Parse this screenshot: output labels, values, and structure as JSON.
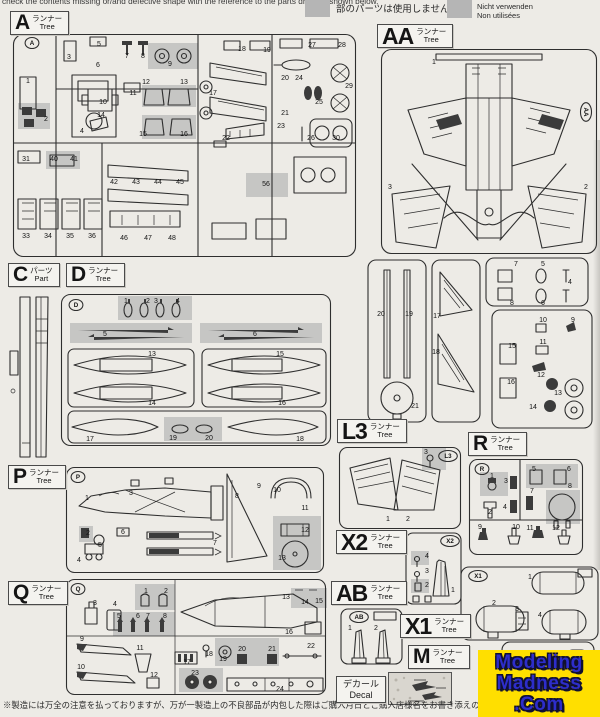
{
  "header": {
    "notice_en": "check the contents missing or/and defective shape with the reference to the parts drawing shown below.",
    "gray_note_jp": "部のパーツは使用しません。",
    "gray_note_en": "Parts not for use.",
    "gray_note_de": "Nicht verwenden",
    "gray_note_fr": "Non utilisées",
    "swatch_color": "#b5b5b5"
  },
  "tree_labels": {
    "A": {
      "letter": "A",
      "jp": "ランナー",
      "en": "Tree"
    },
    "AA": {
      "letter": "AA",
      "jp": "ランナー",
      "en": "Tree"
    },
    "C": {
      "letter": "C",
      "jp": "パーツ",
      "en": "Part"
    },
    "D": {
      "letter": "D",
      "jp": "ランナー",
      "en": "Tree"
    },
    "L3": {
      "letter": "L3",
      "jp": "ランナー",
      "en": "Tree"
    },
    "R": {
      "letter": "R",
      "jp": "ランナー",
      "en": "Tree"
    },
    "P": {
      "letter": "P",
      "jp": "ランナー",
      "en": "Tree"
    },
    "X2": {
      "letter": "X2",
      "jp": "ランナー",
      "en": "Tree"
    },
    "Q": {
      "letter": "Q",
      "jp": "ランナー",
      "en": "Tree"
    },
    "AB": {
      "letter": "AB",
      "jp": "ランナー",
      "en": "Tree"
    },
    "X1": {
      "letter": "X1",
      "jp": "ランナー",
      "en": "Tree"
    },
    "M": {
      "letter": "M",
      "jp": "ランナー",
      "en": "Tree"
    },
    "decal": {
      "jp": "デカール",
      "en": "Decal"
    }
  },
  "sprues": {
    "A": {
      "markers": [
        {
          "t": "A",
          "x": 20,
          "y": 10
        }
      ],
      "parts": [
        {
          "n": "1",
          "x": 16,
          "y": 50
        },
        {
          "n": "2",
          "x": 34,
          "y": 88
        },
        {
          "n": "3",
          "x": 57,
          "y": 26
        },
        {
          "n": "4",
          "x": 70,
          "y": 100
        },
        {
          "n": "5",
          "x": 87,
          "y": 13
        },
        {
          "n": "6",
          "x": 86,
          "y": 34
        },
        {
          "n": "7",
          "x": 115,
          "y": 25
        },
        {
          "n": "8",
          "x": 131,
          "y": 25
        },
        {
          "n": "9",
          "x": 158,
          "y": 33
        },
        {
          "n": "10",
          "x": 91,
          "y": 71
        },
        {
          "n": "11",
          "x": 121,
          "y": 62
        },
        {
          "n": "12",
          "x": 134,
          "y": 51
        },
        {
          "n": "13",
          "x": 172,
          "y": 51
        },
        {
          "n": "14",
          "x": 89,
          "y": 84
        },
        {
          "n": "15",
          "x": 131,
          "y": 103
        },
        {
          "n": "16",
          "x": 172,
          "y": 103
        },
        {
          "n": "17",
          "x": 201,
          "y": 62
        },
        {
          "n": "18",
          "x": 230,
          "y": 18
        },
        {
          "n": "19",
          "x": 255,
          "y": 19
        },
        {
          "n": "20",
          "x": 273,
          "y": 47
        },
        {
          "n": "21",
          "x": 273,
          "y": 82
        },
        {
          "n": "22",
          "x": 214,
          "y": 107
        },
        {
          "n": "23",
          "x": 269,
          "y": 95
        },
        {
          "n": "24",
          "x": 287,
          "y": 47
        },
        {
          "n": "25",
          "x": 307,
          "y": 71
        },
        {
          "n": "26",
          "x": 299,
          "y": 107
        },
        {
          "n": "27",
          "x": 300,
          "y": 14
        },
        {
          "n": "28",
          "x": 330,
          "y": 14
        },
        {
          "n": "29",
          "x": 337,
          "y": 55
        },
        {
          "n": "30",
          "x": 324,
          "y": 107
        },
        {
          "n": "31",
          "x": 14,
          "y": 128
        },
        {
          "n": "40",
          "x": 42,
          "y": 128
        },
        {
          "n": "41",
          "x": 62,
          "y": 128
        },
        {
          "n": "33",
          "x": 14,
          "y": 205
        },
        {
          "n": "34",
          "x": 36,
          "y": 205
        },
        {
          "n": "35",
          "x": 58,
          "y": 205
        },
        {
          "n": "36",
          "x": 80,
          "y": 205
        },
        {
          "n": "42",
          "x": 102,
          "y": 151
        },
        {
          "n": "43",
          "x": 124,
          "y": 151
        },
        {
          "n": "44",
          "x": 146,
          "y": 151
        },
        {
          "n": "45",
          "x": 168,
          "y": 151
        },
        {
          "n": "46",
          "x": 112,
          "y": 207
        },
        {
          "n": "47",
          "x": 136,
          "y": 207
        },
        {
          "n": "48",
          "x": 160,
          "y": 207
        },
        {
          "n": "56",
          "x": 254,
          "y": 153
        }
      ]
    },
    "AA_main": {
      "markers": [
        {
          "t": "AA",
          "x": 206,
          "y": 64,
          "rot": 90
        }
      ],
      "parts": [
        {
          "n": "1",
          "x": 54,
          "y": 16
        },
        {
          "n": "3",
          "x": 10,
          "y": 141
        },
        {
          "n": "2",
          "x": 206,
          "y": 141
        }
      ]
    },
    "AA_lower": {
      "markers": [],
      "parts": [
        {
          "n": "20",
          "x": 21,
          "y": 58
        },
        {
          "n": "19",
          "x": 49,
          "y": 58
        },
        {
          "n": "21",
          "x": 55,
          "y": 150
        },
        {
          "n": "17",
          "x": 77,
          "y": 60
        },
        {
          "n": "18",
          "x": 76,
          "y": 96
        },
        {
          "n": "7",
          "x": 156,
          "y": 8
        },
        {
          "n": "5",
          "x": 183,
          "y": 8
        },
        {
          "n": "8",
          "x": 152,
          "y": 47
        },
        {
          "n": "6",
          "x": 183,
          "y": 47
        },
        {
          "n": "4",
          "x": 210,
          "y": 26
        },
        {
          "n": "10",
          "x": 183,
          "y": 64
        },
        {
          "n": "9",
          "x": 213,
          "y": 64
        },
        {
          "n": "11",
          "x": 183,
          "y": 86
        },
        {
          "n": "15",
          "x": 152,
          "y": 90
        },
        {
          "n": "12",
          "x": 181,
          "y": 119
        },
        {
          "n": "16",
          "x": 151,
          "y": 126
        },
        {
          "n": "13",
          "x": 198,
          "y": 137
        },
        {
          "n": "14",
          "x": 173,
          "y": 151
        }
      ]
    },
    "D": {
      "markers": [
        {
          "t": "D",
          "x": 16,
          "y": 12
        }
      ],
      "parts": [
        {
          "n": "1",
          "x": 66,
          "y": 10
        },
        {
          "n": "2",
          "x": 88,
          "y": 10
        },
        {
          "n": "3",
          "x": 96,
          "y": 10
        },
        {
          "n": "4",
          "x": 118,
          "y": 10
        },
        {
          "n": "5",
          "x": 45,
          "y": 43
        },
        {
          "n": "6",
          "x": 195,
          "y": 43
        },
        {
          "n": "13",
          "x": 92,
          "y": 63
        },
        {
          "n": "14",
          "x": 92,
          "y": 112
        },
        {
          "n": "15",
          "x": 220,
          "y": 63
        },
        {
          "n": "16",
          "x": 222,
          "y": 112
        },
        {
          "n": "17",
          "x": 30,
          "y": 148
        },
        {
          "n": "18",
          "x": 240,
          "y": 148
        },
        {
          "n": "19",
          "x": 113,
          "y": 147
        },
        {
          "n": "20",
          "x": 149,
          "y": 147
        }
      ]
    },
    "L3": {
      "markers": [
        {
          "t": "L3",
          "x": 110,
          "y": 10
        }
      ],
      "parts": [
        {
          "n": "1",
          "x": 50,
          "y": 75
        },
        {
          "n": "2",
          "x": 70,
          "y": 75
        },
        {
          "n": "3",
          "x": 88,
          "y": 8
        }
      ]
    },
    "R": {
      "markers": [
        {
          "t": "R",
          "x": 14,
          "y": 11
        }
      ],
      "parts": [
        {
          "n": "1",
          "x": 24,
          "y": 20
        },
        {
          "n": "2",
          "x": 22,
          "y": 56
        },
        {
          "n": "3",
          "x": 38,
          "y": 25
        },
        {
          "n": "4",
          "x": 37,
          "y": 51
        },
        {
          "n": "5",
          "x": 66,
          "y": 13
        },
        {
          "n": "6",
          "x": 101,
          "y": 13
        },
        {
          "n": "7",
          "x": 64,
          "y": 35
        },
        {
          "n": "8",
          "x": 102,
          "y": 30
        },
        {
          "n": "9",
          "x": 12,
          "y": 71
        },
        {
          "n": "10",
          "x": 48,
          "y": 71
        },
        {
          "n": "11",
          "x": 62,
          "y": 72
        },
        {
          "n": "12",
          "x": 88,
          "y": 72
        }
      ]
    },
    "P": {
      "markers": [
        {
          "t": "P",
          "x": 13,
          "y": 11
        }
      ],
      "parts": [
        {
          "n": "1",
          "x": 22,
          "y": 34
        },
        {
          "n": "3",
          "x": 66,
          "y": 29
        },
        {
          "n": "2",
          "x": 23,
          "y": 69
        },
        {
          "n": "4",
          "x": 14,
          "y": 96
        },
        {
          "n": "5",
          "x": 35,
          "y": 81
        },
        {
          "n": "6",
          "x": 58,
          "y": 68
        },
        {
          "n": "7",
          "x": 150,
          "y": 79
        },
        {
          "n": "8",
          "x": 172,
          "y": 32
        },
        {
          "n": "9",
          "x": 194,
          "y": 22
        },
        {
          "n": "10",
          "x": 212,
          "y": 26
        },
        {
          "n": "11",
          "x": 240,
          "y": 44
        },
        {
          "n": "12",
          "x": 240,
          "y": 66
        },
        {
          "n": "13",
          "x": 217,
          "y": 94
        }
      ]
    },
    "Q": {
      "markers": [
        {
          "t": "Q",
          "x": 13,
          "y": 11
        }
      ],
      "parts": [
        {
          "n": "3",
          "x": 30,
          "y": 27
        },
        {
          "n": "4",
          "x": 50,
          "y": 28
        },
        {
          "n": "1",
          "x": 81,
          "y": 15
        },
        {
          "n": "2",
          "x": 101,
          "y": 15
        },
        {
          "n": "5",
          "x": 54,
          "y": 40
        },
        {
          "n": "6",
          "x": 73,
          "y": 40
        },
        {
          "n": "7",
          "x": 83,
          "y": 40
        },
        {
          "n": "8",
          "x": 100,
          "y": 40
        },
        {
          "n": "9",
          "x": 17,
          "y": 63
        },
        {
          "n": "10",
          "x": 16,
          "y": 91
        },
        {
          "n": "11",
          "x": 75,
          "y": 72
        },
        {
          "n": "12",
          "x": 89,
          "y": 99
        },
        {
          "n": "13",
          "x": 221,
          "y": 21
        },
        {
          "n": "14",
          "x": 240,
          "y": 26
        },
        {
          "n": "15",
          "x": 254,
          "y": 25
        },
        {
          "n": "16",
          "x": 224,
          "y": 56
        },
        {
          "n": "17",
          "x": 122,
          "y": 86
        },
        {
          "n": "18",
          "x": 144,
          "y": 78
        },
        {
          "n": "19",
          "x": 158,
          "y": 83
        },
        {
          "n": "20",
          "x": 177,
          "y": 73
        },
        {
          "n": "21",
          "x": 207,
          "y": 73
        },
        {
          "n": "22",
          "x": 246,
          "y": 70
        },
        {
          "n": "23",
          "x": 130,
          "y": 97
        },
        {
          "n": "24",
          "x": 215,
          "y": 113
        }
      ]
    },
    "X2": {
      "markers": [
        {
          "t": "X2",
          "x": 45,
          "y": 9
        }
      ],
      "parts": [
        {
          "n": "4",
          "x": 22,
          "y": 26
        },
        {
          "n": "3",
          "x": 22,
          "y": 41
        },
        {
          "n": "2",
          "x": 22,
          "y": 55
        },
        {
          "n": "1",
          "x": 48,
          "y": 60
        }
      ]
    },
    "AB": {
      "markers": [
        {
          "t": "AB",
          "x": 19,
          "y": 9
        }
      ],
      "parts": [
        {
          "n": "1",
          "x": 10,
          "y": 22
        },
        {
          "n": "2",
          "x": 36,
          "y": 22
        }
      ]
    },
    "X1": {
      "markers": [
        {
          "t": "X1",
          "x": 18,
          "y": 10
        }
      ],
      "parts": [
        {
          "n": "1",
          "x": 70,
          "y": 13
        },
        {
          "n": "2",
          "x": 34,
          "y": 39
        },
        {
          "n": "3",
          "x": 57,
          "y": 45
        },
        {
          "n": "4",
          "x": 80,
          "y": 51
        }
      ]
    },
    "M": {
      "markers": [],
      "parts": []
    }
  },
  "logo": {
    "word1": "Modeling",
    "word2": "Madness",
    "word3": ".Com",
    "bg_color": "#ffdf00",
    "text_color": "#2d2dcb",
    "outline_color": "#101030"
  },
  "footer": {
    "caution_jp": "※製造には万全の注意を払っておりますが、万が一製造上の不良部品が内包した際はご購入月日とご購入店様名をお書き添えの上、不良箇所を撮影した画像を添え"
  },
  "colors": {
    "not_for_use_gray": "#c6c6c4",
    "sprue_line": "#2e2e2e",
    "paper": "#edebe6"
  }
}
